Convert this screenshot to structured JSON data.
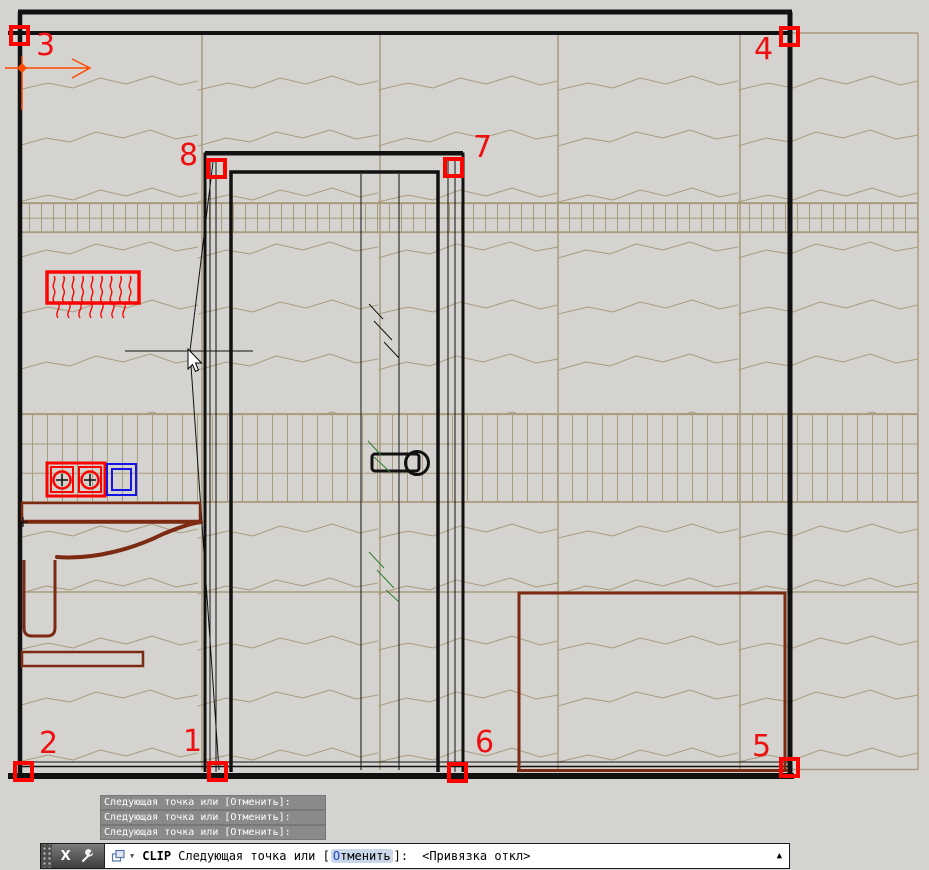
{
  "markers": [
    "1",
    "2",
    "3",
    "4",
    "5",
    "6",
    "7",
    "8"
  ],
  "command_history": [
    "Следующая точка или [Отменить]:",
    "Следующая точка или [Отменить]:",
    "Следующая точка или [Отменить]:"
  ],
  "command_line": {
    "close_label": "X",
    "command": "CLIP",
    "prompt_prefix": "Следующая точка или [",
    "option_initial": "О",
    "option_rest": "тменить",
    "prompt_suffix": "]:",
    "hint": "<Привязка откл>",
    "expand_arrow": "▲"
  },
  "colors": {
    "marker_red": "#ff0000",
    "linework_black": "#111111",
    "fixture_maroon": "#7c2a12",
    "hatch_tan": "#a89a7c",
    "selection_blue": "#1414e6",
    "axis_orange": "#ff4a00",
    "glass_green": "#2d7d2d",
    "history_gray": "#8a8a8a"
  }
}
